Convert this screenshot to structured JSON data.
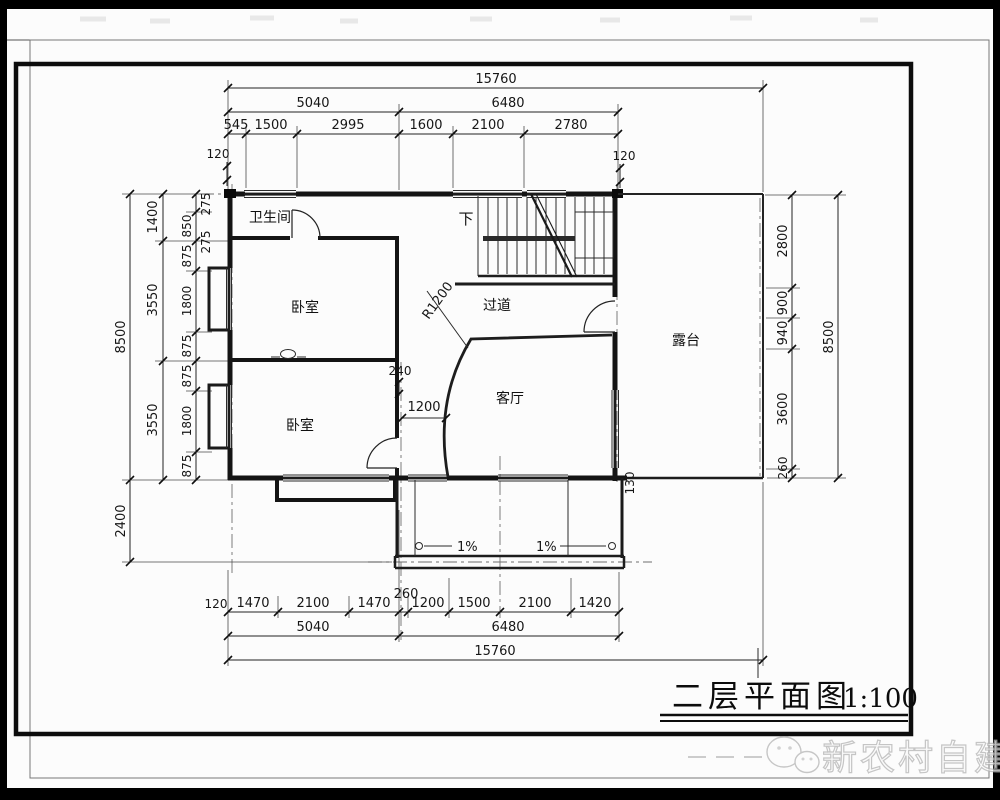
{
  "title": {
    "text": "二层平面图",
    "scale": "1:100"
  },
  "watermark": {
    "text": "新农村自建房",
    "logo": "wechat-icon"
  },
  "rooms": {
    "bathroom": "卫生间",
    "bedroom_upper": "卧室",
    "bedroom_lower": "卧室",
    "hallway": "过道",
    "living": "客厅",
    "terrace": "露台",
    "stairs_down": "下"
  },
  "annotations": {
    "radius": "R1200",
    "wall_240": "240",
    "opening_1200": "1200",
    "slope_left": "1%",
    "slope_right": "1%",
    "gap_130": "130",
    "center_260": "260",
    "offset_275a": "275",
    "offset_275b": "275"
  },
  "dims": {
    "top": {
      "total": "15760",
      "left_half": "5040",
      "right_half": "6480",
      "segs": [
        "545",
        "1500",
        "2995",
        "1600",
        "2100",
        "2780"
      ],
      "wall_left": "120",
      "wall_right": "120"
    },
    "bottom": {
      "total": "15760",
      "left_half": "5040",
      "right_half": "6480",
      "segs": [
        "1470",
        "2100",
        "1470",
        "1200",
        "1500",
        "2100",
        "1420"
      ],
      "wall_left": "120"
    },
    "left": {
      "total": "8500",
      "balcony": "2400",
      "mid": [
        "1400",
        "3550",
        "3550"
      ],
      "inner": [
        "850",
        "875",
        "1800",
        "875",
        "875",
        "1800",
        "875"
      ]
    },
    "right": {
      "total": "8500",
      "inner": [
        "2800",
        "900",
        "940",
        "3600",
        "260"
      ]
    }
  }
}
